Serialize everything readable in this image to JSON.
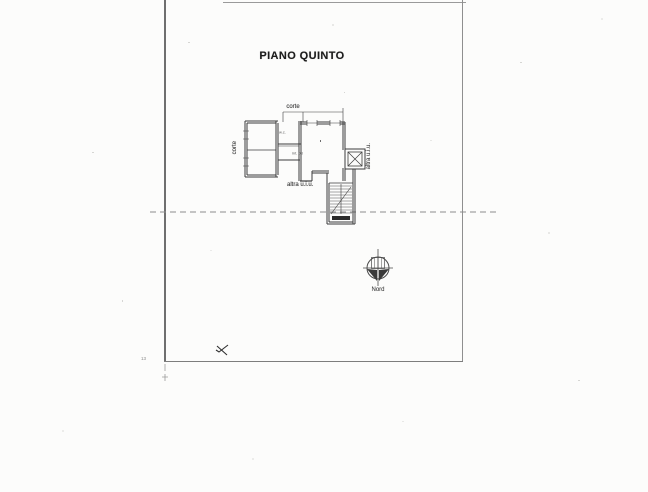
{
  "document": {
    "title": "PIANO QUINTO",
    "floor_plan": {
      "labels": {
        "courtyard_top": "corte",
        "courtyard_left": "corte",
        "wc_room": "w.c.",
        "unit_number": "int. 08",
        "other_unit_bottom": "altra u.i.u.",
        "other_unit_right": "altra u.i.u."
      }
    },
    "compass": {
      "label": "Nord"
    },
    "margin_mark": "13"
  },
  "colors": {
    "paper": "#fcfcfb",
    "frame_line": "#8a8a8a",
    "plan_line": "#3c3c3c",
    "dashed_section_line": "#8c8c8c"
  }
}
